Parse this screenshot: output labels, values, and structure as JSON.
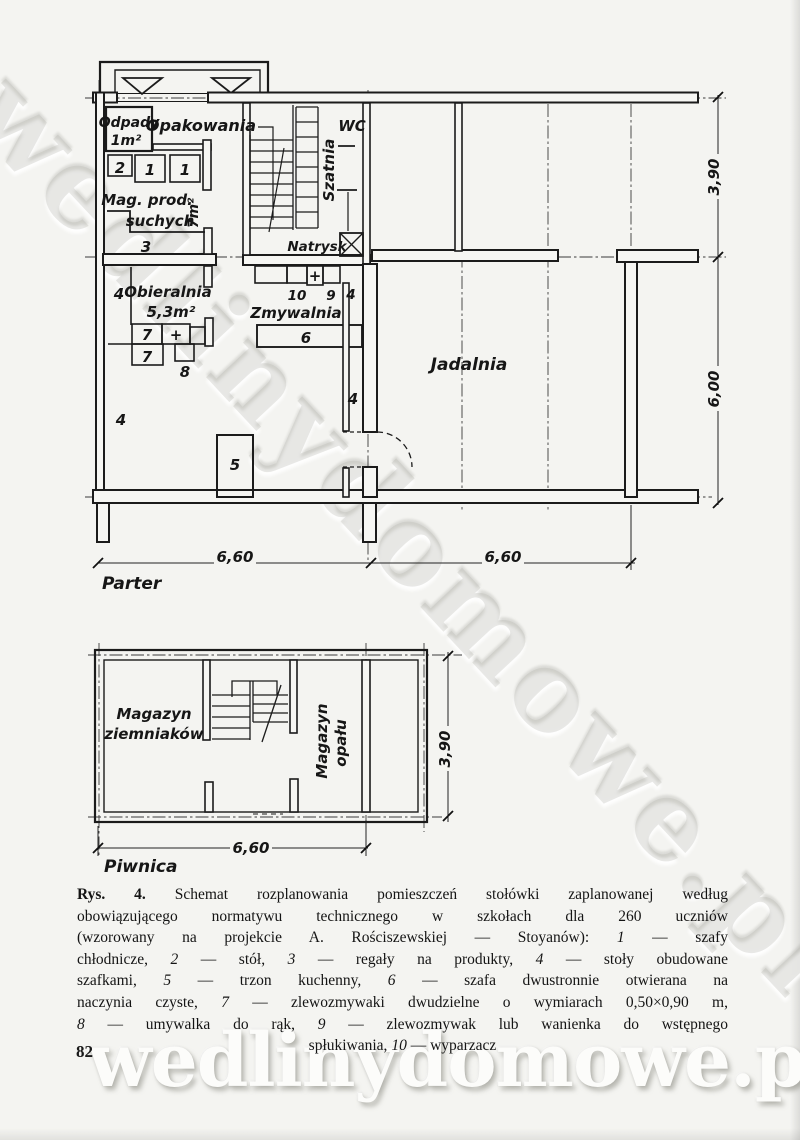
{
  "page": {
    "number": "82",
    "watermark": "wedlinydomowe.pl"
  },
  "plans": {
    "ground": {
      "floor_label": "Parter",
      "rooms": {
        "odpady": "Odpady",
        "odpady_area": "1m²",
        "opakowania": "Opakowania",
        "mag_prod1": "Mag. prod.",
        "mag_prod2": "suchych",
        "mag_area": "7m²",
        "obieralnia": "Obieralnia",
        "obieralnia_area": "5,3m²",
        "szatnia": "Szatnia",
        "wc": "WC",
        "natrysk": "Natrysk",
        "zmywalnia": "Zmywalnia",
        "jadalnia": "Jadalnia"
      }
    },
    "basement": {
      "floor_label": "Piwnica",
      "rooms": {
        "ziemniakow1": "Magazyn",
        "ziemniakow2": "ziemniaków",
        "opalu1": "Magazyn",
        "opalu2": "opału"
      }
    },
    "numbers": {
      "1": "1",
      "2": "2",
      "3": "3",
      "4": "4",
      "5": "5",
      "6": "6",
      "7": "7",
      "8": "8",
      "9": "9",
      "10": "10",
      "plus": "+"
    },
    "dims": {
      "d660": "6,60",
      "d390": "3,90",
      "d600": "6,00"
    }
  },
  "caption": {
    "lines": [
      {
        "parts": [
          {
            "t": "Rys. 4.",
            "b": true
          },
          {
            "t": " Schemat rozplanowania pomieszczeń stołówki zaplanowanej według"
          }
        ]
      },
      {
        "parts": [
          {
            "t": "obowiązującego normatywu technicznego w szkołach dla 260 uczniów"
          }
        ]
      },
      {
        "parts": [
          {
            "t": "(wzorowany na projekcie A. Rościszewskiej — Stoyanów): "
          },
          {
            "t": "1",
            "i": true
          },
          {
            "t": " — szafy"
          }
        ]
      },
      {
        "parts": [
          {
            "t": "chłodnicze, "
          },
          {
            "t": "2",
            "i": true
          },
          {
            "t": " — stół, "
          },
          {
            "t": "3",
            "i": true
          },
          {
            "t": " — regały na produkty, "
          },
          {
            "t": "4",
            "i": true
          },
          {
            "t": " — stoły obudowane"
          }
        ]
      },
      {
        "parts": [
          {
            "t": "szafkami, "
          },
          {
            "t": "5",
            "i": true
          },
          {
            "t": " — trzon kuchenny, "
          },
          {
            "t": "6",
            "i": true
          },
          {
            "t": " — szafa dwustronnie otwierana na"
          }
        ]
      },
      {
        "parts": [
          {
            "t": "naczynia czyste, "
          },
          {
            "t": "7",
            "i": true
          },
          {
            "t": " — zlewozmywaki dwudzielne o wymiarach 0,50×0,90 m,"
          }
        ]
      },
      {
        "parts": [
          {
            "t": "8",
            "i": true
          },
          {
            "t": " — umywalka do rąk, "
          },
          {
            "t": "9",
            "i": true
          },
          {
            "t": " — zlewozmywak lub wanienka do wstępnego"
          }
        ]
      },
      {
        "parts": [
          {
            "t": "spłukiwania, "
          },
          {
            "t": "10",
            "i": true
          },
          {
            "t": " — wyparzacz"
          }
        ],
        "center": true
      }
    ]
  }
}
